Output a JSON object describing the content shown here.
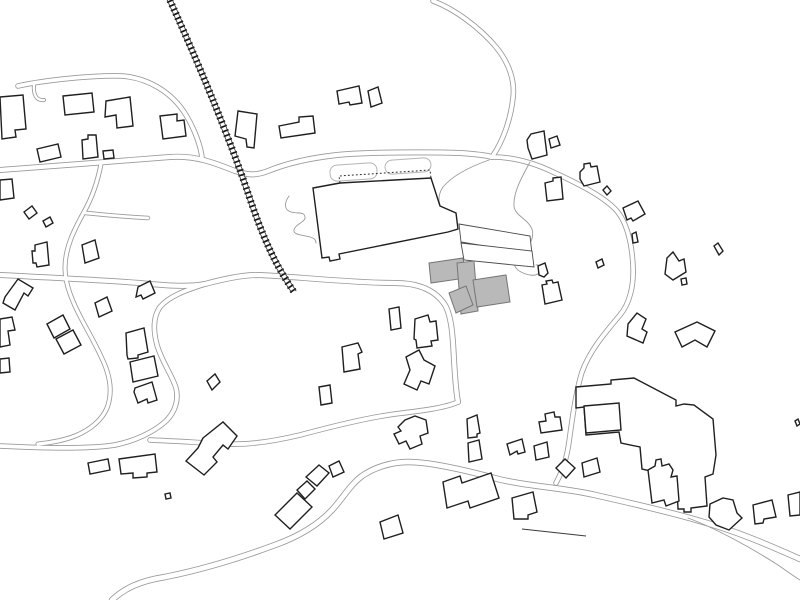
{
  "canvas": {
    "width": 800,
    "height": 600,
    "background": "#ffffff"
  },
  "palette": {
    "building_stroke": "#1f1f1f",
    "building_fill": "#ffffff",
    "thin_stroke": "#4a4a4a",
    "road_stroke": "#9a9a9a",
    "road_fill": "#ffffff",
    "rail_tie_color": "#151515",
    "rail_line_color": "#333333",
    "gray_fill": "#b9b9b9",
    "gray_stroke": "#767676",
    "path_stroke": "#9a9a9a",
    "lobe_stroke": "#b5b5b5",
    "dotted_color": "#2a2a2a",
    "wall_stroke": "#3a3a3a"
  },
  "railway": {
    "name": "railway-track",
    "center": "M168,-4 C196,58 226,128 249,196 C268,253 282,274 294,292",
    "tie_width": 7,
    "tie_dash": "1.7 3",
    "rail_width": 0.8,
    "rail_dx": 2.2,
    "rail_dy": 0.9
  },
  "roads": [
    {
      "name": "road-northwest",
      "w": 5.5,
      "d": "M18,86 C45,80 95,75 122,76 C148,78 172,92 186,115 C195,130 201,147 202,158"
    },
    {
      "name": "road-west-horizontal",
      "w": 6.0,
      "d": "M0,170 C40,167 120,161 170,157 C195,155 215,163 235,171 C248,175 255,176 268,171 C285,164 310,158 337,155 C365,152 430,152 460,153 C475,154 485,155 492,157"
    },
    {
      "name": "road-north",
      "w": 5.5,
      "d": "M433,1 C455,9 480,28 496,47 C510,64 515,82 513,98 C511,117 504,140 492,157"
    },
    {
      "name": "road-east-loop",
      "w": 5.5,
      "d": "M492,157 C510,157 530,161 553,172 C577,183 603,196 616,210 C627,222 632,244 633,266 C634,285 630,303 620,315 C605,333 590,350 582,372 C576,391 572,420 569,442 C567,457 562,472 556,483"
    },
    {
      "name": "road-center",
      "w": 6.0,
      "d": "M0,275 C40,277 100,280 140,283 C170,286 190,287 205,284 C220,280 240,275 258,275 C290,276 350,283 395,283 C420,283 436,291 445,305 C452,317 453,340 454,360 C455,377 456,392 458,402"
    },
    {
      "name": "road-s-curve",
      "w": 5.5,
      "d": "M205,284 C190,289 170,295 160,307 C153,317 153,330 157,345 C162,362 172,375 176,388 C179,400 175,412 166,421 C154,432 135,441 115,445 C90,449 40,448 0,446"
    },
    {
      "name": "road-junction-west",
      "w": 5.5,
      "d": "M458,402 C445,408 420,411 395,414 C365,418 330,427 300,435 C275,441 250,445 228,444 C205,443 175,441 150,440"
    },
    {
      "name": "road-left-winding",
      "w": 5.0,
      "d": "M101,164 C98,180 93,196 84,212 C74,230 65,248 65,268 C65,285 73,303 82,320 C91,337 100,352 106,368 C111,382 112,395 107,408 C102,420 90,430 75,436 C65,440 50,443 38,444"
    },
    {
      "name": "road-stub",
      "w": 4.5,
      "d": "M86,213 C105,215 130,217 148,218"
    },
    {
      "name": "road-stub-nw",
      "w": 4.0,
      "d": "M34,84 C33,94 36,101 44,100"
    },
    {
      "name": "road-diagonal-south",
      "w": 6.5,
      "d": "M112,600 C125,588 140,581 165,577 C200,570 240,558 275,545 C300,536 318,525 332,510 C343,498 350,485 362,476 C375,467 392,462 408,462 C430,462 465,470 498,479 C530,487 560,487 595,495 C635,504 670,512 700,521 C740,532 775,548 800,559"
    }
  ],
  "paths": [
    {
      "name": "footpath-east-squiggle",
      "d": "M530,162 C523,175 513,192 514,206 C515,216 528,219 532,229 C535,240 528,247 519,254 C512,260 513,268 521,272 C527,275 535,277 539,273 C543,269 540,264 536,265"
    },
    {
      "name": "footpath-northeast",
      "d": "M489,160 C472,166 453,175 443,187 C439,193 438,199 440,205"
    },
    {
      "name": "footpath-west-wiggle",
      "d": "M289,196 C284,203 284,210 291,212 C298,214 304,211 305,217 C306,222 295,224 294,230 C293,235 303,235 310,237 C314,238 316,240 316,243"
    },
    {
      "name": "footpath-fork-southeast",
      "d": "M688,518 C715,528 750,547 778,565 C788,572 795,577 800,580"
    }
  ],
  "dotted_lines": [
    {
      "name": "canopy-dotted-outline",
      "d": "M340,183 L339,176 L430,170 L431,178"
    }
  ],
  "walls": [
    {
      "name": "retaining-wall",
      "d": "M522,529 L586,536"
    }
  ],
  "lobes": [
    {
      "name": "landscape-lobe-1",
      "x": 330,
      "y": 164,
      "w": 47,
      "h": 16,
      "rot": -4
    },
    {
      "name": "landscape-lobe-2",
      "x": 385,
      "y": 159,
      "w": 46,
      "h": 14,
      "rot": -4
    }
  ],
  "buildings": [
    {
      "name": "building-edge-nw",
      "type": "building",
      "points": "0,97 23,95 26,129 15,130 16,137 2,139"
    },
    {
      "name": "building-tl-1",
      "type": "building",
      "points": "63,96 92,93 94,112 65,115"
    },
    {
      "name": "building-tl-2",
      "type": "building",
      "points": "106,101 130,97 133,126 117,128 116,115 105,117"
    },
    {
      "name": "building-tl-3",
      "type": "building",
      "points": "160,116 177,114 177,121 184,120 186,136 163,139"
    },
    {
      "name": "building-tl-4",
      "type": "building",
      "points": "82,140 88,139 88,135 96,135 98,157 83,159"
    },
    {
      "name": "building-tl-5",
      "type": "building",
      "points": "37,149 58,144 61,157 40,162"
    },
    {
      "name": "building-tl-6",
      "type": "building",
      "points": "103,151 113,150 114,158 104,159"
    },
    {
      "name": "building-by-rail",
      "type": "building",
      "points": "238,111 257,114 254,148 247,147 246,139 235,136"
    },
    {
      "name": "building-ct-1",
      "type": "building",
      "points": "279,126 299,122 299,117 313,116 315,133 281,138"
    },
    {
      "name": "building-ct-2",
      "type": "building",
      "points": "337,91 359,86 362,103 350,105 349,102 339,104"
    },
    {
      "name": "building-ct-3",
      "type": "building",
      "points": "368,91 378,87 382,103 371,107"
    },
    {
      "name": "building-ne-house",
      "type": "building",
      "points": "527,140 531,134 544,131 547,155 532,159 528,148"
    },
    {
      "name": "building-ne-annex",
      "type": "building",
      "points": "549,139 557,136 560,145 551,148"
    },
    {
      "name": "building-ne-2",
      "type": "building",
      "points": "580,172 584,168 584,164 590,163 591,167 597,166 600,182 584,186 580,179"
    },
    {
      "name": "building-ne-diamond",
      "type": "building",
      "points": "603,190 607,186 611,191 607,195"
    },
    {
      "name": "building-c-house",
      "type": "building",
      "points": "545,183 553,181 553,178 561,177 563,199 547,201"
    },
    {
      "name": "building-lm-edge",
      "type": "building",
      "points": "0,180 12,179 14,198 0,200"
    },
    {
      "name": "building-lm-d1",
      "type": "building",
      "points": "24,212 32,206 37,213 29,219"
    },
    {
      "name": "building-lm-d2",
      "type": "building",
      "points": "43,221 50,217 53,223 46,227"
    },
    {
      "name": "building-lm-1",
      "type": "building",
      "points": "35,245 47,242 49,265 37,267 36,263 33,263 32,251 35,251"
    },
    {
      "name": "building-lm-zigzag",
      "type": "building",
      "points": "5,297 18,279 33,288 28,296 24,293 15,310 3,303"
    },
    {
      "name": "building-lm-sq1",
      "type": "building",
      "points": "82,245 95,240 99,258 85,263"
    },
    {
      "name": "building-lm-sq2",
      "type": "building",
      "points": "95,303 107,297 112,311 99,317"
    },
    {
      "name": "building-lm-sq3",
      "type": "building",
      "points": "138,287 150,281 155,293 143,299 141,295 136,297"
    },
    {
      "name": "building-lm-sq4",
      "type": "building",
      "points": "207,381 215,374 220,382 212,390"
    },
    {
      "name": "building-pair-a",
      "type": "building",
      "points": "47,324 63,315 70,329 54,338"
    },
    {
      "name": "building-pair-b",
      "type": "building",
      "points": "56,339 73,330 81,345 64,354"
    },
    {
      "name": "building-cl-1",
      "type": "building",
      "points": "126,333 144,328 148,352 138,355 138,358 128,359 127,355"
    },
    {
      "name": "building-cl-2",
      "type": "building",
      "points": "130,362 154,356 158,376 133,382"
    },
    {
      "name": "building-cl-3",
      "type": "building",
      "points": "135,388 152,382 157,400 148,403 147,399 138,403 134,392"
    },
    {
      "name": "building-edge-w1",
      "type": "building",
      "points": "0,319 12,317 15,330 8,331 10,345 0,347"
    },
    {
      "name": "building-edge-w2",
      "type": "building",
      "points": "0,359 9,358 10,372 0,373"
    },
    {
      "name": "main-hall",
      "type": "building",
      "points": "313,188 340,183 431,178 440,206 456,213 458,229 448,232 339,254 340,259 330,261 329,257 322,258"
    },
    {
      "name": "wing-a",
      "type": "thin",
      "points": "459,224 530,236 532,254 461,242"
    },
    {
      "name": "wing-b",
      "type": "thin",
      "points": "461,243 532,251 534,267 464,260"
    },
    {
      "name": "gray-extension-1",
      "type": "gray",
      "points": "429,263 463,258 466,278 431,283"
    },
    {
      "name": "gray-extension-2",
      "type": "gray",
      "points": "457,263 474,261 478,311 461,314"
    },
    {
      "name": "gray-extension-3",
      "type": "gray",
      "points": "449,293 466,286 473,305 456,313"
    },
    {
      "name": "gray-extension-4",
      "type": "gray",
      "points": "473,280 506,275 510,302 477,307"
    },
    {
      "name": "building-cs-1",
      "type": "building",
      "points": "389,309 399,307 401,328 391,330"
    },
    {
      "name": "building-cs-2",
      "type": "building",
      "points": "415,319 428,315 430,322 436,321 438,340 431,341 432,346 417,348 416,340 414,339"
    },
    {
      "name": "building-cs-3",
      "type": "building",
      "points": "342,347 358,343 362,352 358,354 360,369 344,372"
    },
    {
      "name": "building-cs-4",
      "type": "building",
      "points": "319,387 330,385 332,403 321,405"
    },
    {
      "name": "building-cs-L",
      "type": "building",
      "points": "406,357 419,350 424,360 435,366 429,384 421,381 417,390 404,384 410,370"
    },
    {
      "name": "building-tiny-L",
      "type": "building",
      "points": "538,266 545,263 548,273 544,277 539,275"
    },
    {
      "name": "building-tiny-sq",
      "type": "building",
      "points": "596,262 602,259 604,265 598,268"
    },
    {
      "name": "building-cr-house",
      "type": "building",
      "points": "542,285 547,284 546,281 552,280 553,283 558,282 562,300 545,304"
    },
    {
      "name": "building-er-1",
      "type": "building",
      "points": "623,208 638,201 645,214 633,221 631,218 627,220"
    },
    {
      "name": "building-er-2",
      "type": "building",
      "points": "632,234 636,232 638,242 633,243"
    },
    {
      "name": "building-er-boot",
      "type": "building",
      "points": "667,258 673,252 679,261 684,259 686,272 673,280 665,274"
    },
    {
      "name": "building-er-boot-sq",
      "type": "building",
      "points": "681,279 686,278 687,284 682,285"
    },
    {
      "name": "building-er-bar",
      "type": "building",
      "points": "714,246 718,243 723,251 719,255"
    },
    {
      "name": "building-er-L",
      "type": "building",
      "points": "628,324 637,313 646,319 642,329 647,332 643,343 627,336"
    },
    {
      "name": "building-pentagon",
      "type": "building",
      "points": "697,322 715,331 707,347 695,340 682,347 675,332"
    },
    {
      "name": "building-bc-T",
      "type": "building",
      "points": "398,427 405,420 415,416 426,420 428,433 420,436 422,444 410,449 406,441 399,444 394,434 401,431"
    },
    {
      "name": "building-bc-2a",
      "type": "building",
      "points": "467,419 477,415 480,433 477,434 477,437 468,438"
    },
    {
      "name": "building-bc-2b",
      "type": "building",
      "points": "468,443 479,440 482,459 469,462"
    },
    {
      "name": "building-bc-3",
      "type": "building",
      "points": "539,422 546,421 545,414 554,412 555,417 560,417 562,430 541,433"
    },
    {
      "name": "building-bc-4",
      "type": "building",
      "points": "507,444 522,439 525,452 518,454 517,451 510,455"
    },
    {
      "name": "building-bc-5",
      "type": "building",
      "points": "534,446 547,442 549,457 536,460"
    },
    {
      "name": "building-bc-diamond",
      "type": "building",
      "points": "556,468 565,459 575,468 566,478"
    },
    {
      "name": "building-bc-6",
      "type": "building",
      "points": "582,463 597,458 600,472 584,477"
    },
    {
      "name": "building-bc-7",
      "type": "building",
      "points": "380,522 398,515 403,533 384,539"
    },
    {
      "name": "building-bc-long",
      "type": "building",
      "points": "443,482 460,476 462,483 491,473 499,498 470,508 468,501 447,508"
    },
    {
      "name": "building-bc-8",
      "type": "building",
      "points": "512,498 533,492 537,512 528,515 528,519 514,519"
    },
    {
      "name": "building-bl-1",
      "type": "building",
      "points": "88,463 108,459 110,470 90,474"
    },
    {
      "name": "building-bl-2",
      "type": "building",
      "points": "119,459 155,454 157,472 147,473 147,477 133,478 133,473 121,474"
    },
    {
      "name": "building-bl-dot",
      "type": "building",
      "points": "165,494 170,493 171,498 166,499"
    },
    {
      "name": "building-bl-rotated",
      "type": "building",
      "points": "203,438 223,422 237,436 228,449 223,445 213,457 217,462 204,475 186,461 198,448"
    },
    {
      "name": "building-chain-1",
      "type": "building",
      "points": "275,515 297,493 312,507 290,529"
    },
    {
      "name": "building-chain-2",
      "type": "building",
      "points": "297,490 307,481 315,489 305,499"
    },
    {
      "name": "building-chain-3",
      "type": "building",
      "points": "306,477 319,465 329,473 317,486"
    },
    {
      "name": "building-chain-4",
      "type": "building",
      "points": "329,466 339,461 344,472 333,477"
    },
    {
      "name": "complex-southeast",
      "type": "building",
      "points": "576,387 611,384 611,380 634,378 676,400 676,406 684,404 694,405 713,419 716,455 713,474 705,477 707,506 691,508 691,512 684,512 684,509 678,509 677,486 661,487 659,473 642,469 640,447 621,443 619,432 586,435 584,407 576,408"
    },
    {
      "name": "complex-inner-room",
      "type": "room",
      "points": "584,406 619,403 621,430 586,433"
    },
    {
      "name": "building-br-spiky",
      "type": "building",
      "points": "648,470 655,466 656,460 661,459 662,466 669,464 673,470 671,477 677,476 679,501 666,506 664,500 652,503"
    },
    {
      "name": "building-br-1",
      "type": "building",
      "points": "710,504 723,498 733,500 737,513 742,518 729,530 716,525 709,517"
    },
    {
      "name": "building-br-2",
      "type": "building",
      "points": "753,505 772,500 776,517 764,519 763,523 755,524"
    },
    {
      "name": "building-edge-e1",
      "type": "building",
      "points": "788,495 800,492 800,515 790,516"
    },
    {
      "name": "building-edge-e2",
      "type": "building",
      "points": "795,421 798,419 800,424 797,426"
    }
  ]
}
